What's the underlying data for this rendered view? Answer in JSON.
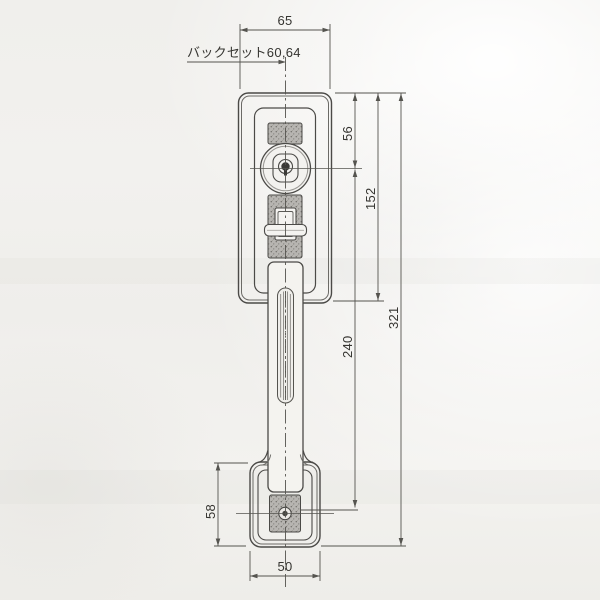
{
  "drawing": {
    "labels": {
      "backset": "バックセット60,64",
      "width_top": "65",
      "cylinder_offset": "56",
      "plate_length": "152",
      "grip_pitch": "240",
      "total_length": "321",
      "bottom_plate_length": "58",
      "bottom_width": "50"
    },
    "colors": {
      "paper": "#f1f0ed",
      "line": "#4b4a47",
      "dimension_line": "#55544f",
      "hatch_fill": "#b7b5b1",
      "text": "#353430"
    }
  }
}
